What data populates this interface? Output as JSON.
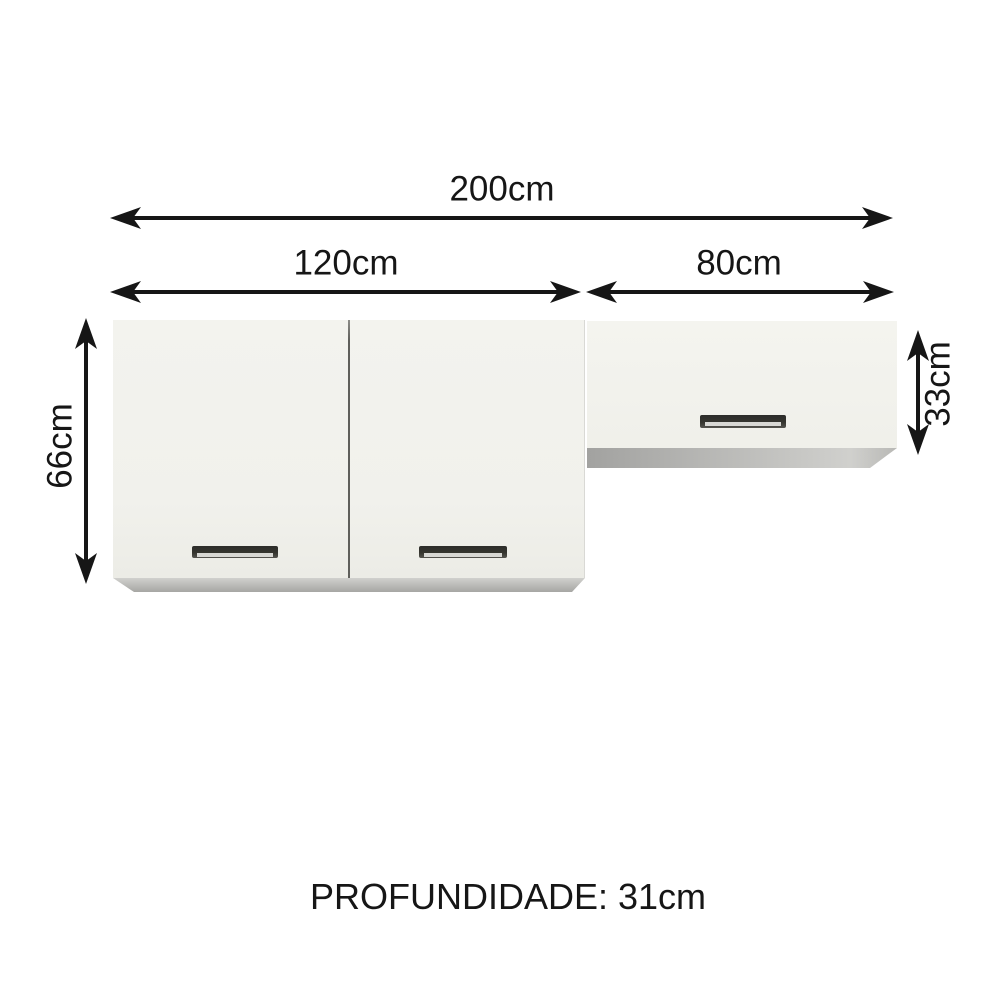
{
  "labels": {
    "total_width": "200cm",
    "left_cabinet_width": "120cm",
    "right_cabinet_width": "80cm",
    "left_cabinet_height": "66cm",
    "right_cabinet_height": "33cm",
    "depth": "PROFUNDIDADE: 31cm"
  },
  "colors": {
    "background": "#ffffff",
    "arrow": "#161616",
    "text": "#161616",
    "cabinet_face": "#f1f1ec",
    "cabinet_face_light": "#f4f4ef",
    "cabinet_bottom_light": "#d0d0cd",
    "cabinet_bottom_dark": "#a6a6a3",
    "door_divider": "#5f5f5b",
    "handle_dark": "#35352f",
    "handle_light": "#d8d8d4"
  }
}
